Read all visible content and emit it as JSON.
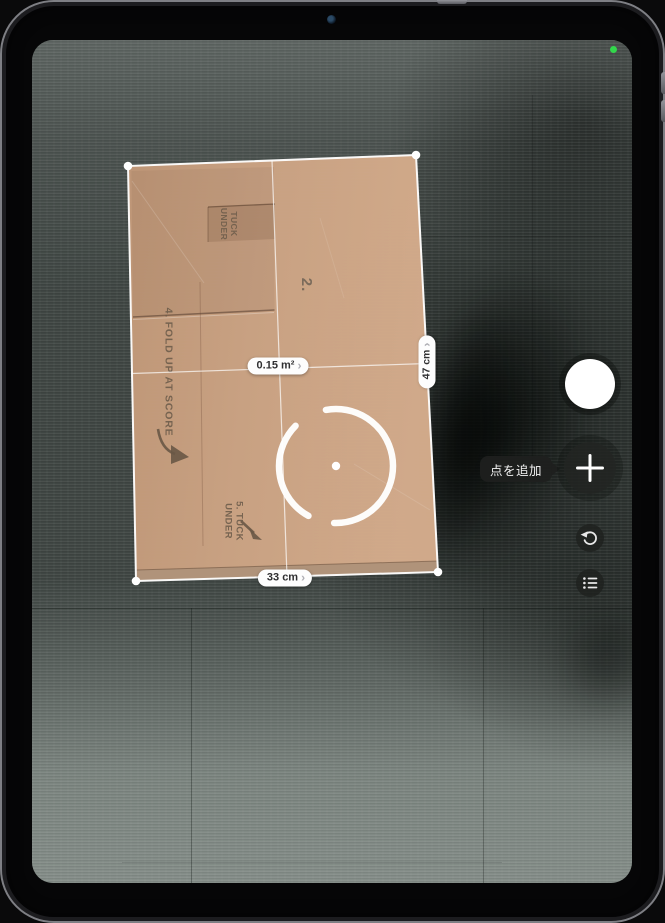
{
  "app": {
    "name": "Measure"
  },
  "ar_labels": {
    "area": {
      "text": "0.15 m²",
      "chevron": "›"
    },
    "right_edge": {
      "text": "47 cm",
      "chevron": "›"
    },
    "bottom_edge": {
      "text": "33 cm",
      "chevron": "›"
    }
  },
  "tooltip": {
    "text": "点を追加"
  },
  "box_print": {
    "step2": "2.",
    "tuck_top": "TUCK\nUNDER",
    "fold": "4. FOLD UP AT SCORE",
    "tuck_bottom": "5. TUCK\nUNDER"
  },
  "status": {
    "camera_indicator_color": "#32d74b"
  },
  "colors": {
    "cardboard": "#cda686",
    "carpet": "#414845",
    "measure_line": "#ffffff"
  }
}
